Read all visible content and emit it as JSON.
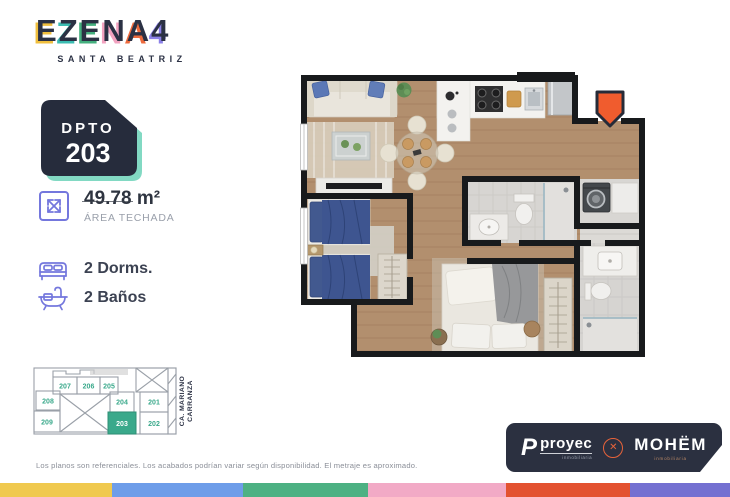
{
  "brand": {
    "logo_letters": [
      {
        "char": "E",
        "color": "#f0bf3e"
      },
      {
        "char": "Z",
        "color": "#3bbcb2"
      },
      {
        "char": "E",
        "color": "#44af7e"
      },
      {
        "char": "N",
        "color": "#f2a3c0"
      },
      {
        "char": "A",
        "color": "#ed6a3d"
      },
      {
        "char": "4",
        "color": "#8b80e8"
      }
    ],
    "subtitle": "SANTA BEATRIZ"
  },
  "unit": {
    "badge_label": "DPTO",
    "badge_number": "203"
  },
  "specs": {
    "area": {
      "value": "49.78",
      "unit": "m²",
      "label": "ÁREA TECHADA"
    },
    "bedrooms_label": "2 Dorms.",
    "bathrooms_label": "2 Baños"
  },
  "keyplan": {
    "street_line1": "CA. MARIANO",
    "street_line2": "CARRANZA",
    "number_color": "#3aa98b",
    "highlight_color": "#3aa98b",
    "highlight_text_color": "#ffffff",
    "units": [
      {
        "label": "207"
      },
      {
        "label": "206"
      },
      {
        "label": "205"
      },
      {
        "label": "208"
      },
      {
        "label": "204"
      },
      {
        "label": "201"
      },
      {
        "label": "209"
      },
      {
        "label": "203"
      },
      {
        "label": "202"
      }
    ]
  },
  "floorplan": {
    "entrance_marker_color": "#f05c2e"
  },
  "footer": {
    "disclaimer": "Los planos son referenciales. Los acabados podrían variar según disponibilidad. El metraje es aproximado.",
    "partners": {
      "primary_initial": "P",
      "primary": "proyec",
      "primary_sub": "inmobiliaria",
      "separator": "✕",
      "secondary": "MOHËM",
      "secondary_sub": "inmobiliaria"
    },
    "stripe_colors": [
      "#f0c94f",
      "#6e9de9",
      "#4db183",
      "#f2aac6",
      "#e35230",
      "#7470d1"
    ],
    "stripe_widths": [
      112,
      131,
      125,
      138,
      124,
      100
    ]
  }
}
